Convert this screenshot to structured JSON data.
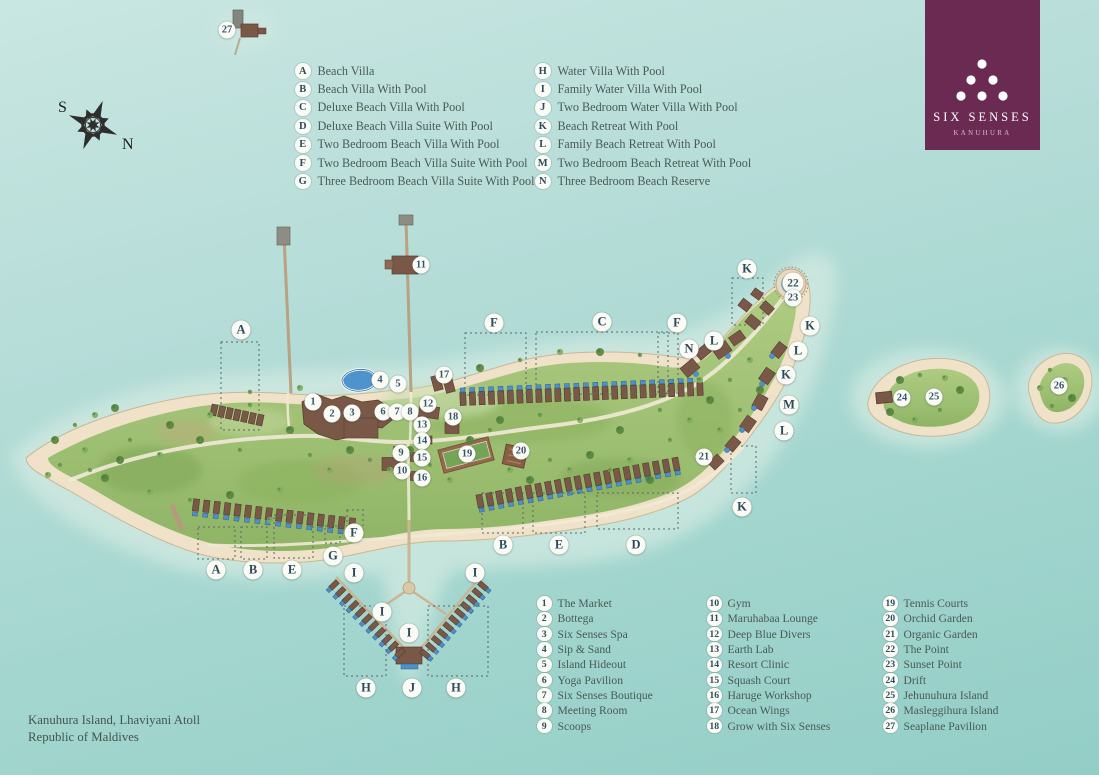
{
  "title": "Six Senses Kanuhura Resort Map",
  "logo": {
    "brand": "SIX SENSES",
    "property": "KANUHURA",
    "bg_color": "#6b2a52"
  },
  "compass": {
    "south_label": "S",
    "north_label": "N"
  },
  "location": {
    "line1": "Kanuhura Island, Lhaviyani Atoll",
    "line2": "Republic of Maldives"
  },
  "villa_legend": {
    "columns": [
      [
        {
          "key": "A",
          "label": "Beach Villa"
        },
        {
          "key": "B",
          "label": "Beach Villa With Pool"
        },
        {
          "key": "C",
          "label": "Deluxe Beach Villa With Pool"
        },
        {
          "key": "D",
          "label": "Deluxe Beach Villa Suite With Pool"
        },
        {
          "key": "E",
          "label": "Two Bedroom Beach Villa With Pool"
        },
        {
          "key": "F",
          "label": "Two Bedroom Beach Villa Suite With Pool"
        },
        {
          "key": "G",
          "label": "Three Bedroom Beach Villa Suite With Pool"
        }
      ],
      [
        {
          "key": "H",
          "label": "Water Villa With Pool"
        },
        {
          "key": "I",
          "label": "Family Water Villa With Pool"
        },
        {
          "key": "J",
          "label": "Two Bedroom Water Villa With Pool"
        },
        {
          "key": "K",
          "label": "Beach Retreat With Pool"
        },
        {
          "key": "L",
          "label": "Family Beach Retreat With Pool"
        },
        {
          "key": "M",
          "label": "Two Bedroom Beach Retreat With Pool"
        },
        {
          "key": "N",
          "label": "Three Bedroom Beach Reserve"
        }
      ]
    ]
  },
  "facility_legend": {
    "columns": [
      [
        {
          "key": "1",
          "label": "The Market"
        },
        {
          "key": "2",
          "label": "Bottega"
        },
        {
          "key": "3",
          "label": "Six Senses Spa"
        },
        {
          "key": "4",
          "label": "Sip & Sand"
        },
        {
          "key": "5",
          "label": "Island Hideout"
        },
        {
          "key": "6",
          "label": "Yoga Pavilion"
        },
        {
          "key": "7",
          "label": "Six Senses Boutique"
        },
        {
          "key": "8",
          "label": "Meeting Room"
        },
        {
          "key": "9",
          "label": "Scoops"
        }
      ],
      [
        {
          "key": "10",
          "label": "Gym"
        },
        {
          "key": "11",
          "label": "Maruhabaa Lounge"
        },
        {
          "key": "12",
          "label": "Deep Blue Divers"
        },
        {
          "key": "13",
          "label": "Earth Lab"
        },
        {
          "key": "14",
          "label": "Resort Clinic"
        },
        {
          "key": "15",
          "label": "Squash Court"
        },
        {
          "key": "16",
          "label": "Haruge Workshop"
        },
        {
          "key": "17",
          "label": "Ocean Wings"
        },
        {
          "key": "18",
          "label": "Grow with Six Senses"
        }
      ],
      [
        {
          "key": "19",
          "label": "Tennis Courts"
        },
        {
          "key": "20",
          "label": "Orchid Garden"
        },
        {
          "key": "21",
          "label": "Organic Garden"
        },
        {
          "key": "22",
          "label": "The Point"
        },
        {
          "key": "23",
          "label": "Sunset Point"
        },
        {
          "key": "24",
          "label": "Drift"
        },
        {
          "key": "25",
          "label": "Jehunuhura Island"
        },
        {
          "key": "26",
          "label": "Masleggihura Island"
        },
        {
          "key": "27",
          "label": "Seaplane Pavilion"
        }
      ]
    ]
  },
  "map": {
    "letter_markers": [
      {
        "t": "A",
        "x": 241,
        "y": 330
      },
      {
        "t": "F",
        "x": 494,
        "y": 323
      },
      {
        "t": "C",
        "x": 602,
        "y": 322
      },
      {
        "t": "F",
        "x": 677,
        "y": 323
      },
      {
        "t": "N",
        "x": 689,
        "y": 349
      },
      {
        "t": "L",
        "x": 714,
        "y": 341
      },
      {
        "t": "K",
        "x": 747,
        "y": 269
      },
      {
        "t": "K",
        "x": 810,
        "y": 326
      },
      {
        "t": "L",
        "x": 798,
        "y": 351
      },
      {
        "t": "K",
        "x": 786,
        "y": 375
      },
      {
        "t": "M",
        "x": 789,
        "y": 405
      },
      {
        "t": "L",
        "x": 784,
        "y": 431
      },
      {
        "t": "K",
        "x": 742,
        "y": 507
      },
      {
        "t": "F",
        "x": 354,
        "y": 533
      },
      {
        "t": "G",
        "x": 333,
        "y": 556
      },
      {
        "t": "B",
        "x": 503,
        "y": 545
      },
      {
        "t": "E",
        "x": 559,
        "y": 545
      },
      {
        "t": "D",
        "x": 636,
        "y": 545
      },
      {
        "t": "A",
        "x": 216,
        "y": 570
      },
      {
        "t": "B",
        "x": 253,
        "y": 570
      },
      {
        "t": "E",
        "x": 292,
        "y": 570
      },
      {
        "t": "I",
        "x": 354,
        "y": 573
      },
      {
        "t": "I",
        "x": 382,
        "y": 612
      },
      {
        "t": "I",
        "x": 409,
        "y": 633
      },
      {
        "t": "I",
        "x": 475,
        "y": 573
      },
      {
        "t": "H",
        "x": 366,
        "y": 688
      },
      {
        "t": "J",
        "x": 412,
        "y": 688
      },
      {
        "t": "H",
        "x": 456,
        "y": 688
      }
    ],
    "number_markers": [
      {
        "t": "1",
        "x": 313,
        "y": 402
      },
      {
        "t": "2",
        "x": 332,
        "y": 414
      },
      {
        "t": "3",
        "x": 352,
        "y": 413
      },
      {
        "t": "4",
        "x": 380,
        "y": 380
      },
      {
        "t": "5",
        "x": 398,
        "y": 384
      },
      {
        "t": "6",
        "x": 383,
        "y": 412
      },
      {
        "t": "7",
        "x": 397,
        "y": 412
      },
      {
        "t": "8",
        "x": 410,
        "y": 412
      },
      {
        "t": "9",
        "x": 401,
        "y": 453
      },
      {
        "t": "10",
        "x": 402,
        "y": 471
      },
      {
        "t": "11",
        "x": 421,
        "y": 265
      },
      {
        "t": "12",
        "x": 428,
        "y": 404
      },
      {
        "t": "13",
        "x": 422,
        "y": 425
      },
      {
        "t": "14",
        "x": 422,
        "y": 441
      },
      {
        "t": "15",
        "x": 422,
        "y": 458
      },
      {
        "t": "16",
        "x": 422,
        "y": 478
      },
      {
        "t": "17",
        "x": 444,
        "y": 375
      },
      {
        "t": "18",
        "x": 453,
        "y": 417
      },
      {
        "t": "19",
        "x": 467,
        "y": 454
      },
      {
        "t": "20",
        "x": 521,
        "y": 451
      },
      {
        "t": "21",
        "x": 704,
        "y": 457
      },
      {
        "t": "22",
        "x": 793,
        "y": 283,
        "big": true
      },
      {
        "t": "23",
        "x": 793,
        "y": 298
      },
      {
        "t": "24",
        "x": 902,
        "y": 398
      },
      {
        "t": "25",
        "x": 934,
        "y": 397
      },
      {
        "t": "26",
        "x": 1059,
        "y": 386
      },
      {
        "t": "27",
        "x": 227,
        "y": 30
      }
    ],
    "colors": {
      "water_top": "#c9e6e2",
      "water_bottom": "#93cec6",
      "lagoon": "#d5ebe2",
      "sand": "#efe2c8",
      "green": "#a2c278",
      "villa": "#7a5847",
      "pool": "#4f8fca",
      "path": "#f2ead7",
      "marker_text": "#2e4b5c",
      "legend_text": "#4a5a55",
      "logo_bg": "#6b2a52"
    }
  }
}
